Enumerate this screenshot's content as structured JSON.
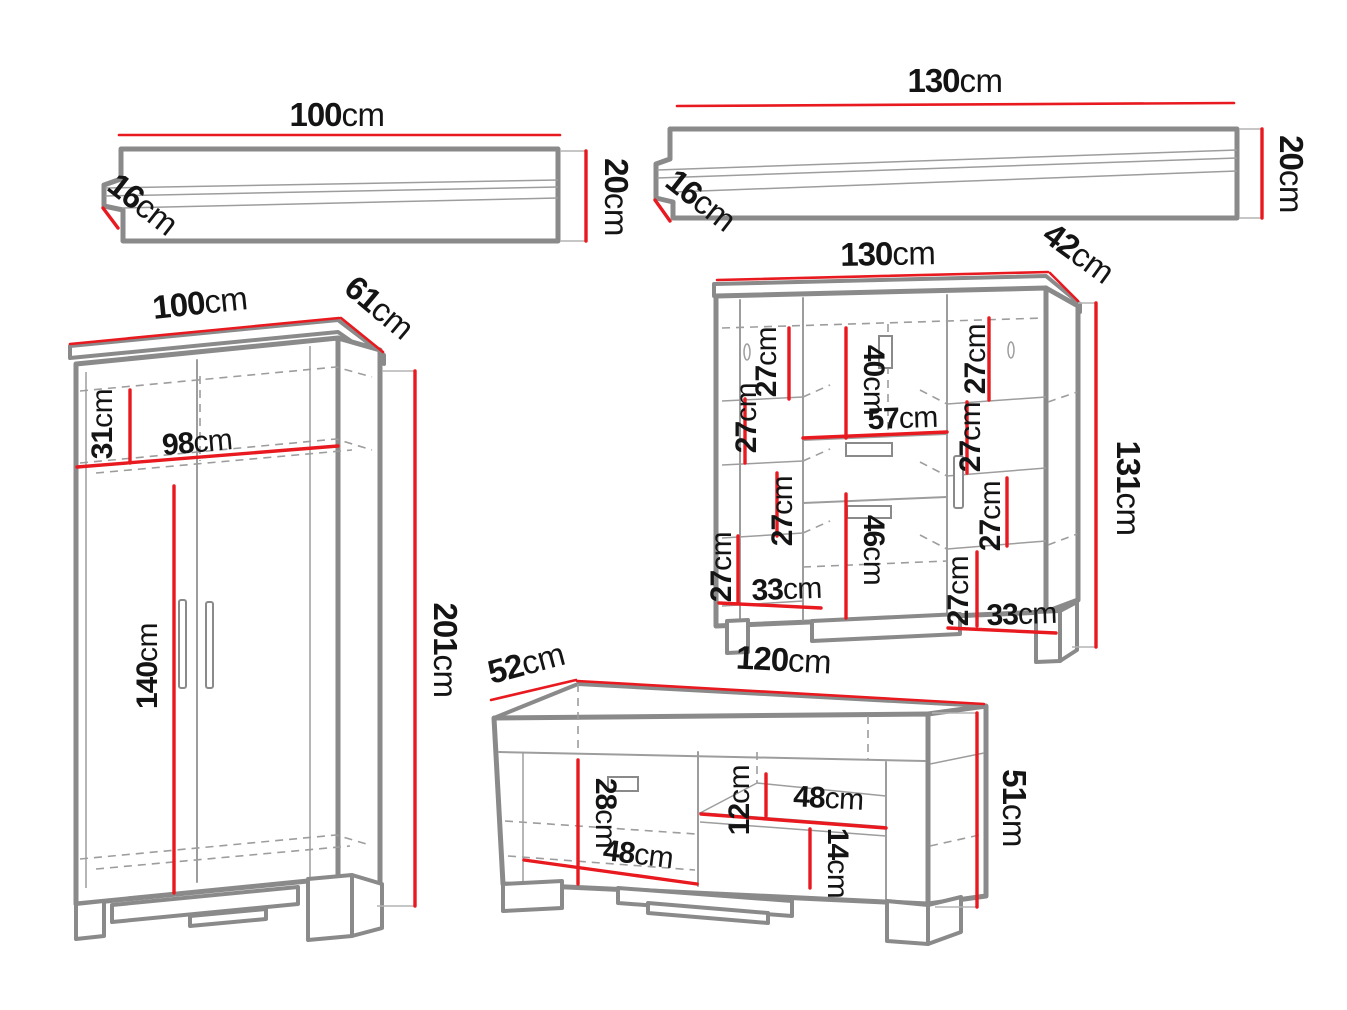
{
  "title": "Furniture set dimensions diagram",
  "colors": {
    "red": "#e8191f",
    "outline": "#8a8a8a",
    "thin": "#9d9d9d",
    "text": "#141414"
  },
  "pieces": {
    "shelf_a": {
      "width": {
        "v": "100",
        "u": "cm"
      },
      "depth": {
        "v": "16",
        "u": "cm"
      },
      "height": {
        "v": "20",
        "u": "cm"
      }
    },
    "shelf_b": {
      "width": {
        "v": "130",
        "u": "cm"
      },
      "depth": {
        "v": "16",
        "u": "cm"
      },
      "height": {
        "v": "20",
        "u": "cm"
      }
    },
    "wardrobe": {
      "width": {
        "v": "100",
        "u": "cm"
      },
      "depth": {
        "v": "61",
        "u": "cm"
      },
      "height": {
        "v": "201",
        "u": "cm"
      },
      "top_section": {
        "v": "31",
        "u": "cm"
      },
      "inner_width": {
        "v": "98",
        "u": "cm"
      },
      "hanging": {
        "v": "140",
        "u": "cm"
      }
    },
    "cabinet": {
      "width": {
        "v": "130",
        "u": "cm"
      },
      "depth": {
        "v": "42",
        "u": "cm"
      },
      "height": {
        "v": "131",
        "u": "cm"
      },
      "upper_door": {
        "v": "40",
        "u": "cm"
      },
      "drawer_width": {
        "v": "57",
        "u": "cm"
      },
      "lower_door": {
        "v": "46",
        "u": "cm"
      },
      "bottom_left": {
        "v": "33",
        "u": "cm"
      },
      "bottom_right": {
        "v": "33",
        "u": "cm"
      },
      "gaps": [
        {
          "v": "27",
          "u": "cm"
        },
        {
          "v": "27",
          "u": "cm"
        },
        {
          "v": "27",
          "u": "cm"
        },
        {
          "v": "27",
          "u": "cm"
        },
        {
          "v": "27",
          "u": "cm"
        },
        {
          "v": "27",
          "u": "cm"
        },
        {
          "v": "27",
          "u": "cm"
        },
        {
          "v": "27",
          "u": "cm"
        }
      ]
    },
    "tv_stand": {
      "width": {
        "v": "120",
        "u": "cm"
      },
      "depth": {
        "v": "52",
        "u": "cm"
      },
      "height": {
        "v": "51",
        "u": "cm"
      },
      "door_height": {
        "v": "28",
        "u": "cm"
      },
      "niche_height": {
        "v": "12",
        "u": "cm"
      },
      "niche_width": {
        "v": "48",
        "u": "cm"
      },
      "drawer_height": {
        "v": "14",
        "u": "cm"
      },
      "door_width": {
        "v": "48",
        "u": "cm"
      }
    }
  }
}
